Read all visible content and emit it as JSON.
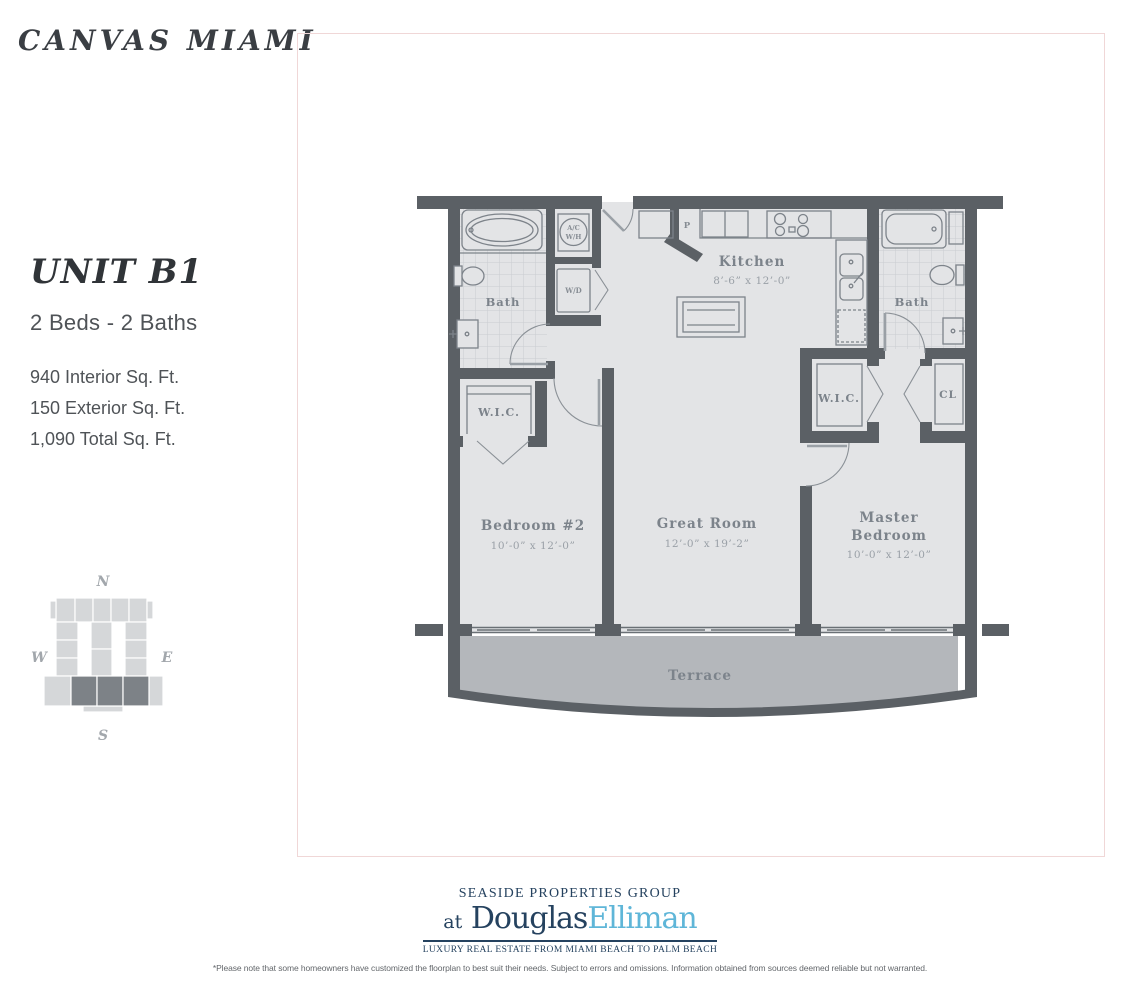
{
  "colors": {
    "wall": "#5b6065",
    "room": "#e3e4e6",
    "tile": "#c9ccd0",
    "terrace": "#b4b7bb",
    "fixture": "#7d838a",
    "label": "#7c838b",
    "dim": "#9aa0a7",
    "ink": "#3a3e43",
    "text": "#4f5357",
    "navy": "#25425f",
    "blue": "#5fb6d8",
    "pink": "#f0d7d7",
    "keylight": "#d5d7d9",
    "keydark": "#7d8287",
    "keyletter": "#a2a7ac",
    "fine": "#63676b"
  },
  "brand": {
    "title": "CANVAS MIAMI"
  },
  "unit": {
    "name": "UNIT B1",
    "beds_baths": "2 Beds - 2 Baths",
    "area_interior": "940 Interior Sq. Ft.",
    "area_exterior": "150 Exterior Sq. Ft.",
    "area_total": "1,090 Total Sq. Ft."
  },
  "compass": {
    "north": "N",
    "south": "S",
    "east": "E",
    "west": "W"
  },
  "plan": {
    "kitchen_name": "Kitchen",
    "kitchen_dims": "8’-6” x 12’-0”",
    "great_room_name": "Great Room",
    "great_room_dims": "12’-0” x 19’-2”",
    "bedroom2_name": "Bedroom #2",
    "bedroom2_dims": "10’-0” x 12’-0”",
    "master_name_1": "Master",
    "master_name_2": "Bedroom",
    "master_dims": "10’-0” x 12’-0”",
    "bath_left": "Bath",
    "bath_right": "Bath",
    "wic_left": "W.I.C.",
    "wic_right": "W.I.C.",
    "closet": "CL",
    "pantry": "P",
    "ac_1": "A/C",
    "ac_2": "W/H",
    "wd": "W/D",
    "terrace": "Terrace"
  },
  "logo": {
    "group": "SEASIDE PROPERTIES GROUP",
    "at": "at",
    "brand_dark": "Douglas",
    "brand_light": "Elliman",
    "tagline": "LUXURY REAL ESTATE FROM MIAMI BEACH TO PALM BEACH"
  },
  "disclaimer": "*Please note that some homeowners have customized the floorplan to best suit their needs. Subject to errors and omissions. Information obtained from sources deemed reliable but not warranted."
}
